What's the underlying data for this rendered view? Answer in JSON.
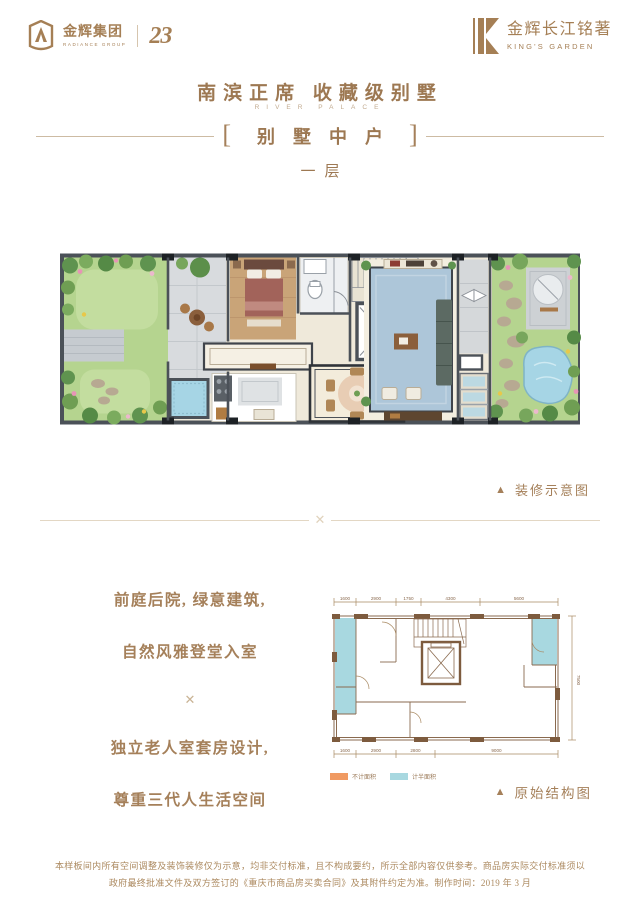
{
  "brand": {
    "left_logo": {
      "name": "金辉集团",
      "sub": "RADIANCE GROUP",
      "badge": "23"
    },
    "right_logo": {
      "name": "金辉长江铭著",
      "sub": "KING'S GARDEN"
    }
  },
  "header": {
    "title": "南滨正席  收藏级别墅",
    "subtitle": "RIVER PALACE",
    "bracket_left": "[",
    "bracket_right": "]",
    "unit_name": "别墅中户",
    "floor": "一层"
  },
  "ornament": "✕",
  "marker": "▲",
  "decor_plan": {
    "caption": "装修示意图"
  },
  "intro": {
    "line1": "前庭后院, 绿意建筑,",
    "line2": "自然风雅登堂入室",
    "line3": "独立老人室套房设计,",
    "line4": "尊重三代人生活空间"
  },
  "structural": {
    "caption": "原始结构图",
    "dims_top": [
      "1600",
      "2900",
      "1750",
      "4300",
      "5600"
    ],
    "dims_bottom": [
      "1600",
      "2900",
      "2800",
      "9000"
    ],
    "dim_right": "7500",
    "legend": [
      {
        "label": "不计面积",
        "color": "#F09A62"
      },
      {
        "label": "计半面积",
        "color": "#A8D8E0"
      }
    ]
  },
  "disclaimer": {
    "line1": "本样板间内所有空间调整及装饰装修仅为示意，均非交付标准，且不构成要约，所示全部内容仅供参考。商品房实际交付标准须以",
    "line2": "政府最终批准文件及双方签订的《重庆市商品房买卖合同》及其附件约定为准。制作时间：2019 年 3 月"
  },
  "colors": {
    "gold_text": "#9D7852",
    "light_rule": "#CDBBA3",
    "wall_dark": "#4B5158",
    "lawn": "#B5D48F",
    "rug_blue": "#ADC6D9",
    "pond_blue": "#A6D5E5",
    "struct_line": "#8A6A4F",
    "struct_cyan": "#A8D8E0",
    "legend_orange": "#F09A62"
  }
}
